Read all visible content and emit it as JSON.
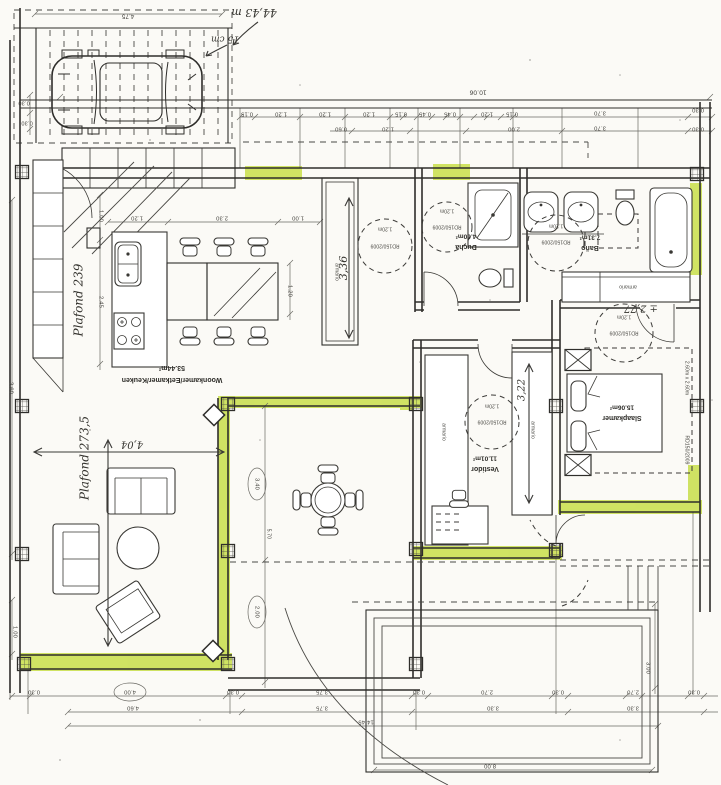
{
  "meta": {
    "description": "Scanned hand-annotated architectural floor plan with carport, living/kitchen, bathrooms, dressing room, bedroom, terrace and pool",
    "width": 721,
    "height": 785
  },
  "colors": {
    "paper": "#fbfaf6",
    "ink": "#2f2e2b",
    "highlight_green": "#c9df4f",
    "gray_fill": "#b3b0a8",
    "hand_ink": "#34332e"
  },
  "texts": [
    {
      "n": "dim-carport-width",
      "t": "4.75",
      "x": 128,
      "y": 16,
      "r": 180,
      "s": 6,
      "k": "dim"
    },
    {
      "n": "dim-left-030-a",
      "t": "0.30",
      "x": 24,
      "y": 103,
      "r": 180,
      "s": 5.5,
      "k": "dim"
    },
    {
      "n": "dim-left-030-b",
      "t": "0.30",
      "x": 27,
      "y": 123,
      "r": 180,
      "s": 5.5,
      "k": "dim"
    },
    {
      "n": "dim-overall-top",
      "t": "10.06",
      "x": 478,
      "y": 92,
      "r": 180,
      "s": 6.5,
      "k": "dim"
    },
    {
      "n": "dim-top-a1",
      "t": "0.15",
      "x": 247,
      "y": 114,
      "r": 180,
      "s": 5.8,
      "k": "dim"
    },
    {
      "n": "dim-top-a2",
      "t": "1.20",
      "x": 281,
      "y": 114,
      "r": 180,
      "s": 5.8,
      "k": "dim"
    },
    {
      "n": "dim-top-a3",
      "t": "1.20",
      "x": 325,
      "y": 114,
      "r": 180,
      "s": 5.8,
      "k": "dim"
    },
    {
      "n": "dim-top-a4",
      "t": "1.20",
      "x": 369,
      "y": 114,
      "r": 180,
      "s": 5.8,
      "k": "dim"
    },
    {
      "n": "dim-top-a5",
      "t": "0.15",
      "x": 401,
      "y": 114,
      "r": 180,
      "s": 5.8,
      "k": "dim"
    },
    {
      "n": "dim-top-a6",
      "t": "0.45",
      "x": 425,
      "y": 114,
      "r": 180,
      "s": 5.8,
      "k": "dim"
    },
    {
      "n": "dim-top-a7",
      "t": "0.45",
      "x": 450,
      "y": 114,
      "r": 180,
      "s": 5.8,
      "k": "dim"
    },
    {
      "n": "dim-top-a8",
      "t": "1.20",
      "x": 487,
      "y": 114,
      "r": 180,
      "s": 5.8,
      "k": "dim"
    },
    {
      "n": "dim-top-a9",
      "t": "0.15",
      "x": 512,
      "y": 114,
      "r": 180,
      "s": 5.8,
      "k": "dim"
    },
    {
      "n": "dim-top-a10",
      "t": "3.70",
      "x": 600,
      "y": 113,
      "r": 180,
      "s": 5.8,
      "k": "dim"
    },
    {
      "n": "dim-top-a11",
      "t": "0.30",
      "x": 698,
      "y": 110,
      "r": 180,
      "s": 5.8,
      "k": "dim"
    },
    {
      "n": "dim-top-b1",
      "t": "0.60",
      "x": 341,
      "y": 129,
      "r": 180,
      "s": 5.8,
      "k": "dim"
    },
    {
      "n": "dim-top-b2",
      "t": "1.20",
      "x": 388,
      "y": 129,
      "r": 180,
      "s": 5.8,
      "k": "dim"
    },
    {
      "n": "dim-top-b3",
      "t": "2.00",
      "x": 514,
      "y": 129,
      "r": 180,
      "s": 5.8,
      "k": "dim"
    },
    {
      "n": "dim-top-b4",
      "t": "3.70",
      "x": 600,
      "y": 128,
      "r": 180,
      "s": 5.8,
      "k": "dim"
    },
    {
      "n": "dim-top-b5",
      "t": "0.30",
      "x": 698,
      "y": 129,
      "r": 180,
      "s": 5.8,
      "k": "dim"
    },
    {
      "n": "dim-kitchen-1",
      "t": "1.20",
      "x": 137,
      "y": 218,
      "r": 180,
      "s": 5.8,
      "k": "dim"
    },
    {
      "n": "dim-kitchen-2",
      "t": "2.30",
      "x": 222,
      "y": 218,
      "r": 180,
      "s": 5.8,
      "k": "dim"
    },
    {
      "n": "dim-kitchen-3",
      "t": "1.00",
      "x": 298,
      "y": 218,
      "r": 180,
      "s": 5.8,
      "k": "dim"
    },
    {
      "n": "dim-kitchen-v1",
      "t": "1.00",
      "x": 101,
      "y": 216,
      "r": 90,
      "s": 5.8,
      "k": "dim"
    },
    {
      "n": "dim-kitchen-v2",
      "t": "2.45",
      "x": 101,
      "y": 302,
      "r": 90,
      "s": 5.8,
      "k": "dim"
    },
    {
      "n": "dim-table-width",
      "t": "1.20",
      "x": 290,
      "y": 291,
      "r": 90,
      "s": 5.8,
      "k": "dim"
    },
    {
      "n": "dim-left-wall-a",
      "t": "3.60",
      "x": 11,
      "y": 388,
      "r": 90,
      "s": 5.8,
      "k": "dim"
    },
    {
      "n": "dim-left-wall-b",
      "t": "1.00",
      "x": 15,
      "y": 632,
      "r": 90,
      "s": 5.8,
      "k": "dim"
    },
    {
      "n": "dim-terrace-1",
      "t": "3.40",
      "x": 257,
      "y": 484,
      "r": 90,
      "s": 5.8,
      "k": "dim"
    },
    {
      "n": "dim-terrace-2",
      "t": "2.00",
      "x": 257,
      "y": 612,
      "r": 90,
      "s": 5.8,
      "k": "dim"
    },
    {
      "n": "dim-terrace-3",
      "t": "5.70",
      "x": 269,
      "y": 534,
      "r": 90,
      "s": 5,
      "k": "dim"
    },
    {
      "n": "dim-bot-a1",
      "t": "0.30",
      "x": 34,
      "y": 692,
      "r": 180,
      "s": 5.8,
      "k": "dim"
    },
    {
      "n": "dim-bot-a2",
      "t": "4.00",
      "x": 130,
      "y": 692,
      "r": 180,
      "s": 5.8,
      "k": "dim"
    },
    {
      "n": "dim-bot-a3",
      "t": "0.30",
      "x": 233,
      "y": 692,
      "r": 180,
      "s": 5.8,
      "k": "dim"
    },
    {
      "n": "dim-bot-a4",
      "t": "3.75",
      "x": 322,
      "y": 692,
      "r": 180,
      "s": 5.8,
      "k": "dim"
    },
    {
      "n": "dim-bot-a5",
      "t": "0.30",
      "x": 419,
      "y": 692,
      "r": 180,
      "s": 5.8,
      "k": "dim"
    },
    {
      "n": "dim-bot-a6",
      "t": "2.70",
      "x": 487,
      "y": 692,
      "r": 180,
      "s": 5.8,
      "k": "dim"
    },
    {
      "n": "dim-bot-a7",
      "t": "0.30",
      "x": 558,
      "y": 692,
      "r": 180,
      "s": 5.8,
      "k": "dim"
    },
    {
      "n": "dim-bot-a8",
      "t": "2.70",
      "x": 633,
      "y": 692,
      "r": 180,
      "s": 5.8,
      "k": "dim"
    },
    {
      "n": "dim-bot-a9",
      "t": "0.30",
      "x": 694,
      "y": 692,
      "r": 180,
      "s": 5.8,
      "k": "dim"
    },
    {
      "n": "dim-bot-b1",
      "t": "4.60",
      "x": 133,
      "y": 708,
      "r": 180,
      "s": 5.8,
      "k": "dim"
    },
    {
      "n": "dim-bot-b2",
      "t": "3.75",
      "x": 322,
      "y": 708,
      "r": 180,
      "s": 5.8,
      "k": "dim"
    },
    {
      "n": "dim-bot-b3",
      "t": "3.30",
      "x": 493,
      "y": 708,
      "r": 180,
      "s": 5.8,
      "k": "dim"
    },
    {
      "n": "dim-bot-b4",
      "t": "3.30",
      "x": 633,
      "y": 708,
      "r": 180,
      "s": 5.8,
      "k": "dim"
    },
    {
      "n": "dim-site-width",
      "t": "14.45",
      "x": 366,
      "y": 722,
      "r": 180,
      "s": 5.8,
      "k": "dim"
    },
    {
      "n": "dim-pool-width",
      "t": "8.00",
      "x": 490,
      "y": 766,
      "r": 180,
      "s": 5.8,
      "k": "dim"
    },
    {
      "n": "dim-pool-height",
      "t": "3.00",
      "x": 648,
      "y": 668,
      "r": 90,
      "s": 5.8,
      "k": "dim"
    },
    {
      "n": "room-area-woonkamer",
      "t": "53.44m²",
      "x": 172,
      "y": 368,
      "r": 180,
      "s": 7,
      "k": "area"
    },
    {
      "n": "room-label-woonkamer",
      "t": "Woonkamer/Eetkamer/Keuken",
      "x": 172,
      "y": 380,
      "r": 180,
      "s": 7,
      "k": "label"
    },
    {
      "n": "room-area-ducha",
      "t": "4.60m²",
      "x": 466,
      "y": 236,
      "r": 180,
      "s": 6.5,
      "k": "area"
    },
    {
      "n": "room-label-ducha",
      "t": "Ducha",
      "x": 466,
      "y": 247,
      "r": 180,
      "s": 7,
      "k": "label"
    },
    {
      "n": "room-area-bano",
      "t": "7.31m²",
      "x": 590,
      "y": 237,
      "r": 180,
      "s": 6.5,
      "k": "area"
    },
    {
      "n": "room-label-bano",
      "t": "Baño",
      "x": 590,
      "y": 248,
      "r": 180,
      "s": 7,
      "k": "label"
    },
    {
      "n": "room-area-vestidor",
      "t": "11.01m²",
      "x": 485,
      "y": 458,
      "r": 180,
      "s": 6.5,
      "k": "area"
    },
    {
      "n": "room-label-vestidor",
      "t": "Vestidor",
      "x": 485,
      "y": 469,
      "r": 180,
      "s": 7,
      "k": "label"
    },
    {
      "n": "room-area-slaapkamer",
      "t": "15.06m²",
      "x": 622,
      "y": 407,
      "r": 180,
      "s": 6.5,
      "k": "area"
    },
    {
      "n": "room-label-slaapkamer",
      "t": "Slaapkamer",
      "x": 622,
      "y": 418,
      "r": 180,
      "s": 7,
      "k": "label"
    },
    {
      "n": "circle-corridor-dia",
      "t": "1.20m",
      "x": 385,
      "y": 229,
      "r": 180,
      "s": 5,
      "k": "small"
    },
    {
      "n": "circle-corridor-code",
      "t": "RD150/2009",
      "x": 385,
      "y": 246,
      "r": 180,
      "s": 5,
      "k": "small"
    },
    {
      "n": "circle-ducha-dia",
      "t": "1.20m",
      "x": 447,
      "y": 211,
      "r": 180,
      "s": 5,
      "k": "small"
    },
    {
      "n": "circle-ducha-code",
      "t": "RD150/2009",
      "x": 447,
      "y": 227,
      "r": 180,
      "s": 5,
      "k": "small"
    },
    {
      "n": "circle-bano-dia",
      "t": "1.20m",
      "x": 556,
      "y": 226,
      "r": 180,
      "s": 5,
      "k": "small"
    },
    {
      "n": "circle-bano-code",
      "t": "RD150/2009",
      "x": 556,
      "y": 242,
      "r": 180,
      "s": 5,
      "k": "small"
    },
    {
      "n": "circle-vestidor-dia",
      "t": "1.20m",
      "x": 492,
      "y": 406,
      "r": 180,
      "s": 5,
      "k": "small"
    },
    {
      "n": "circle-vestidor-code",
      "t": "RD150/2009",
      "x": 492,
      "y": 422,
      "r": 180,
      "s": 5,
      "k": "small"
    },
    {
      "n": "circle-slaapkamer-dia",
      "t": "1.20m",
      "x": 624,
      "y": 317,
      "r": 180,
      "s": 5,
      "k": "small"
    },
    {
      "n": "circle-slaapkamer-code",
      "t": "RD150/2009",
      "x": 624,
      "y": 333,
      "r": 180,
      "s": 5,
      "k": "small"
    },
    {
      "n": "closet-label-hall",
      "t": "armario",
      "x": 337,
      "y": 272,
      "r": 90,
      "s": 5,
      "k": "small"
    },
    {
      "n": "closet-label-bano",
      "t": "armario",
      "x": 628,
      "y": 287,
      "r": 180,
      "s": 5,
      "k": "small"
    },
    {
      "n": "closet-label-vestidor-left",
      "t": "armario",
      "x": 444,
      "y": 432,
      "r": 90,
      "s": 5,
      "k": "small"
    },
    {
      "n": "closet-label-vestidor-right",
      "t": "armario",
      "x": 533,
      "y": 430,
      "r": 90,
      "s": 5,
      "k": "small"
    },
    {
      "n": "bed-clearance-size",
      "t": "2.60m x 2.60m",
      "x": 687,
      "y": 378,
      "r": 90,
      "s": 5,
      "k": "small"
    },
    {
      "n": "bed-clearance-code",
      "t": "RD150/2009",
      "x": 687,
      "y": 450,
      "r": 90,
      "s": 5,
      "k": "small"
    },
    {
      "n": "hand-note-total",
      "t": "44,43 m",
      "x": 254,
      "y": 12,
      "r": 180,
      "s": 11,
      "k": "hand"
    },
    {
      "n": "hand-note-wall",
      "t": "15 cm",
      "x": 225,
      "y": 39,
      "r": 180,
      "s": 9,
      "k": "hand"
    },
    {
      "n": "hand-ceiling-kitchen",
      "t": "Plafond 239",
      "x": 79,
      "y": 300,
      "r": -90,
      "s": 12,
      "k": "hand"
    },
    {
      "n": "hand-ceiling-living",
      "t": "Plafond 273,5",
      "x": 85,
      "y": 458,
      "r": -90,
      "s": 12,
      "k": "hand"
    },
    {
      "n": "hand-wardrobe-length",
      "t": "3,36",
      "x": 344,
      "y": 268,
      "r": -90,
      "s": 11,
      "k": "hand"
    },
    {
      "n": "hand-vestidor-length",
      "t": "3,22",
      "x": 522,
      "y": 390,
      "r": -90,
      "s": 10,
      "k": "hand"
    },
    {
      "n": "hand-closet-length",
      "t": "± 2,77",
      "x": 641,
      "y": 308,
      "r": 180,
      "s": 10,
      "k": "hand"
    },
    {
      "n": "hand-living-width",
      "t": "4,04",
      "x": 132,
      "y": 444,
      "r": 180,
      "s": 10,
      "k": "hand"
    }
  ]
}
